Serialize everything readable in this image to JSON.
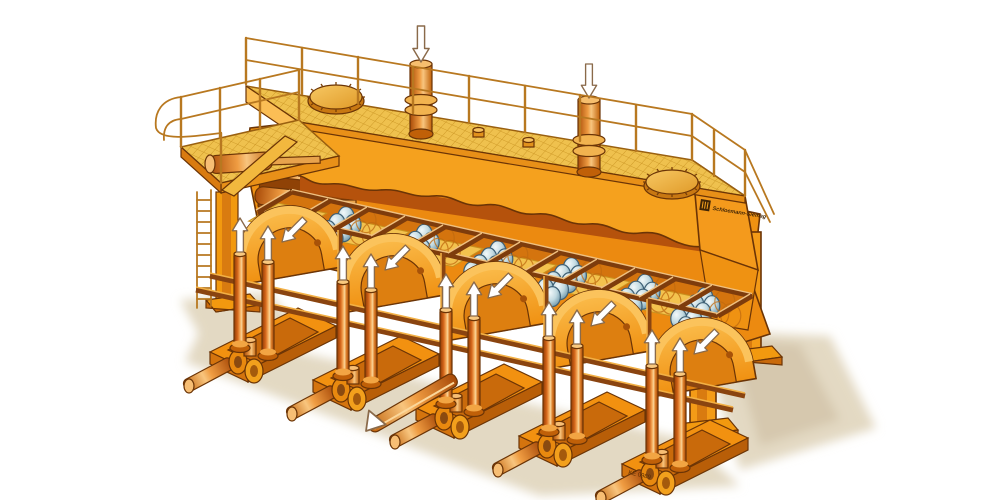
{
  "markings": {
    "manufacturer_wordmark": "Schloemann-Siemag",
    "drawing_number": "KE 0989"
  },
  "palette": {
    "bg": "#FFFFFF",
    "outline": "#6B3406",
    "body": "#F49B17",
    "bodyLight": "#FBBE55",
    "bodyDark": "#D4740E",
    "apron": "#F5A11E",
    "apronShadow": "#B5520C",
    "interior": "#8F4206",
    "deckMesh": "#EFC14E",
    "meshLine": "#C8921F",
    "panel": "#F3C24E",
    "channel": "#D4740E",
    "frameRail": "#7E3C0C",
    "frameLight": "#EFC080",
    "railing": "#B87820",
    "beam": "#8A4410",
    "beamLight": "#F2B045",
    "ballOutline": "#3E5F74",
    "ghost": "#C06A10",
    "arrowFill": "#FFFFFF",
    "arrowStroke": "#8A6A4A",
    "shadow": "#E3D9C3",
    "shadowDark": "#D6C8AE",
    "highlight": "#FFD34E"
  },
  "icons": {
    "down_arrow": "⬇",
    "up_arrow": "⬆",
    "diagonal_arrow": "↙"
  }
}
